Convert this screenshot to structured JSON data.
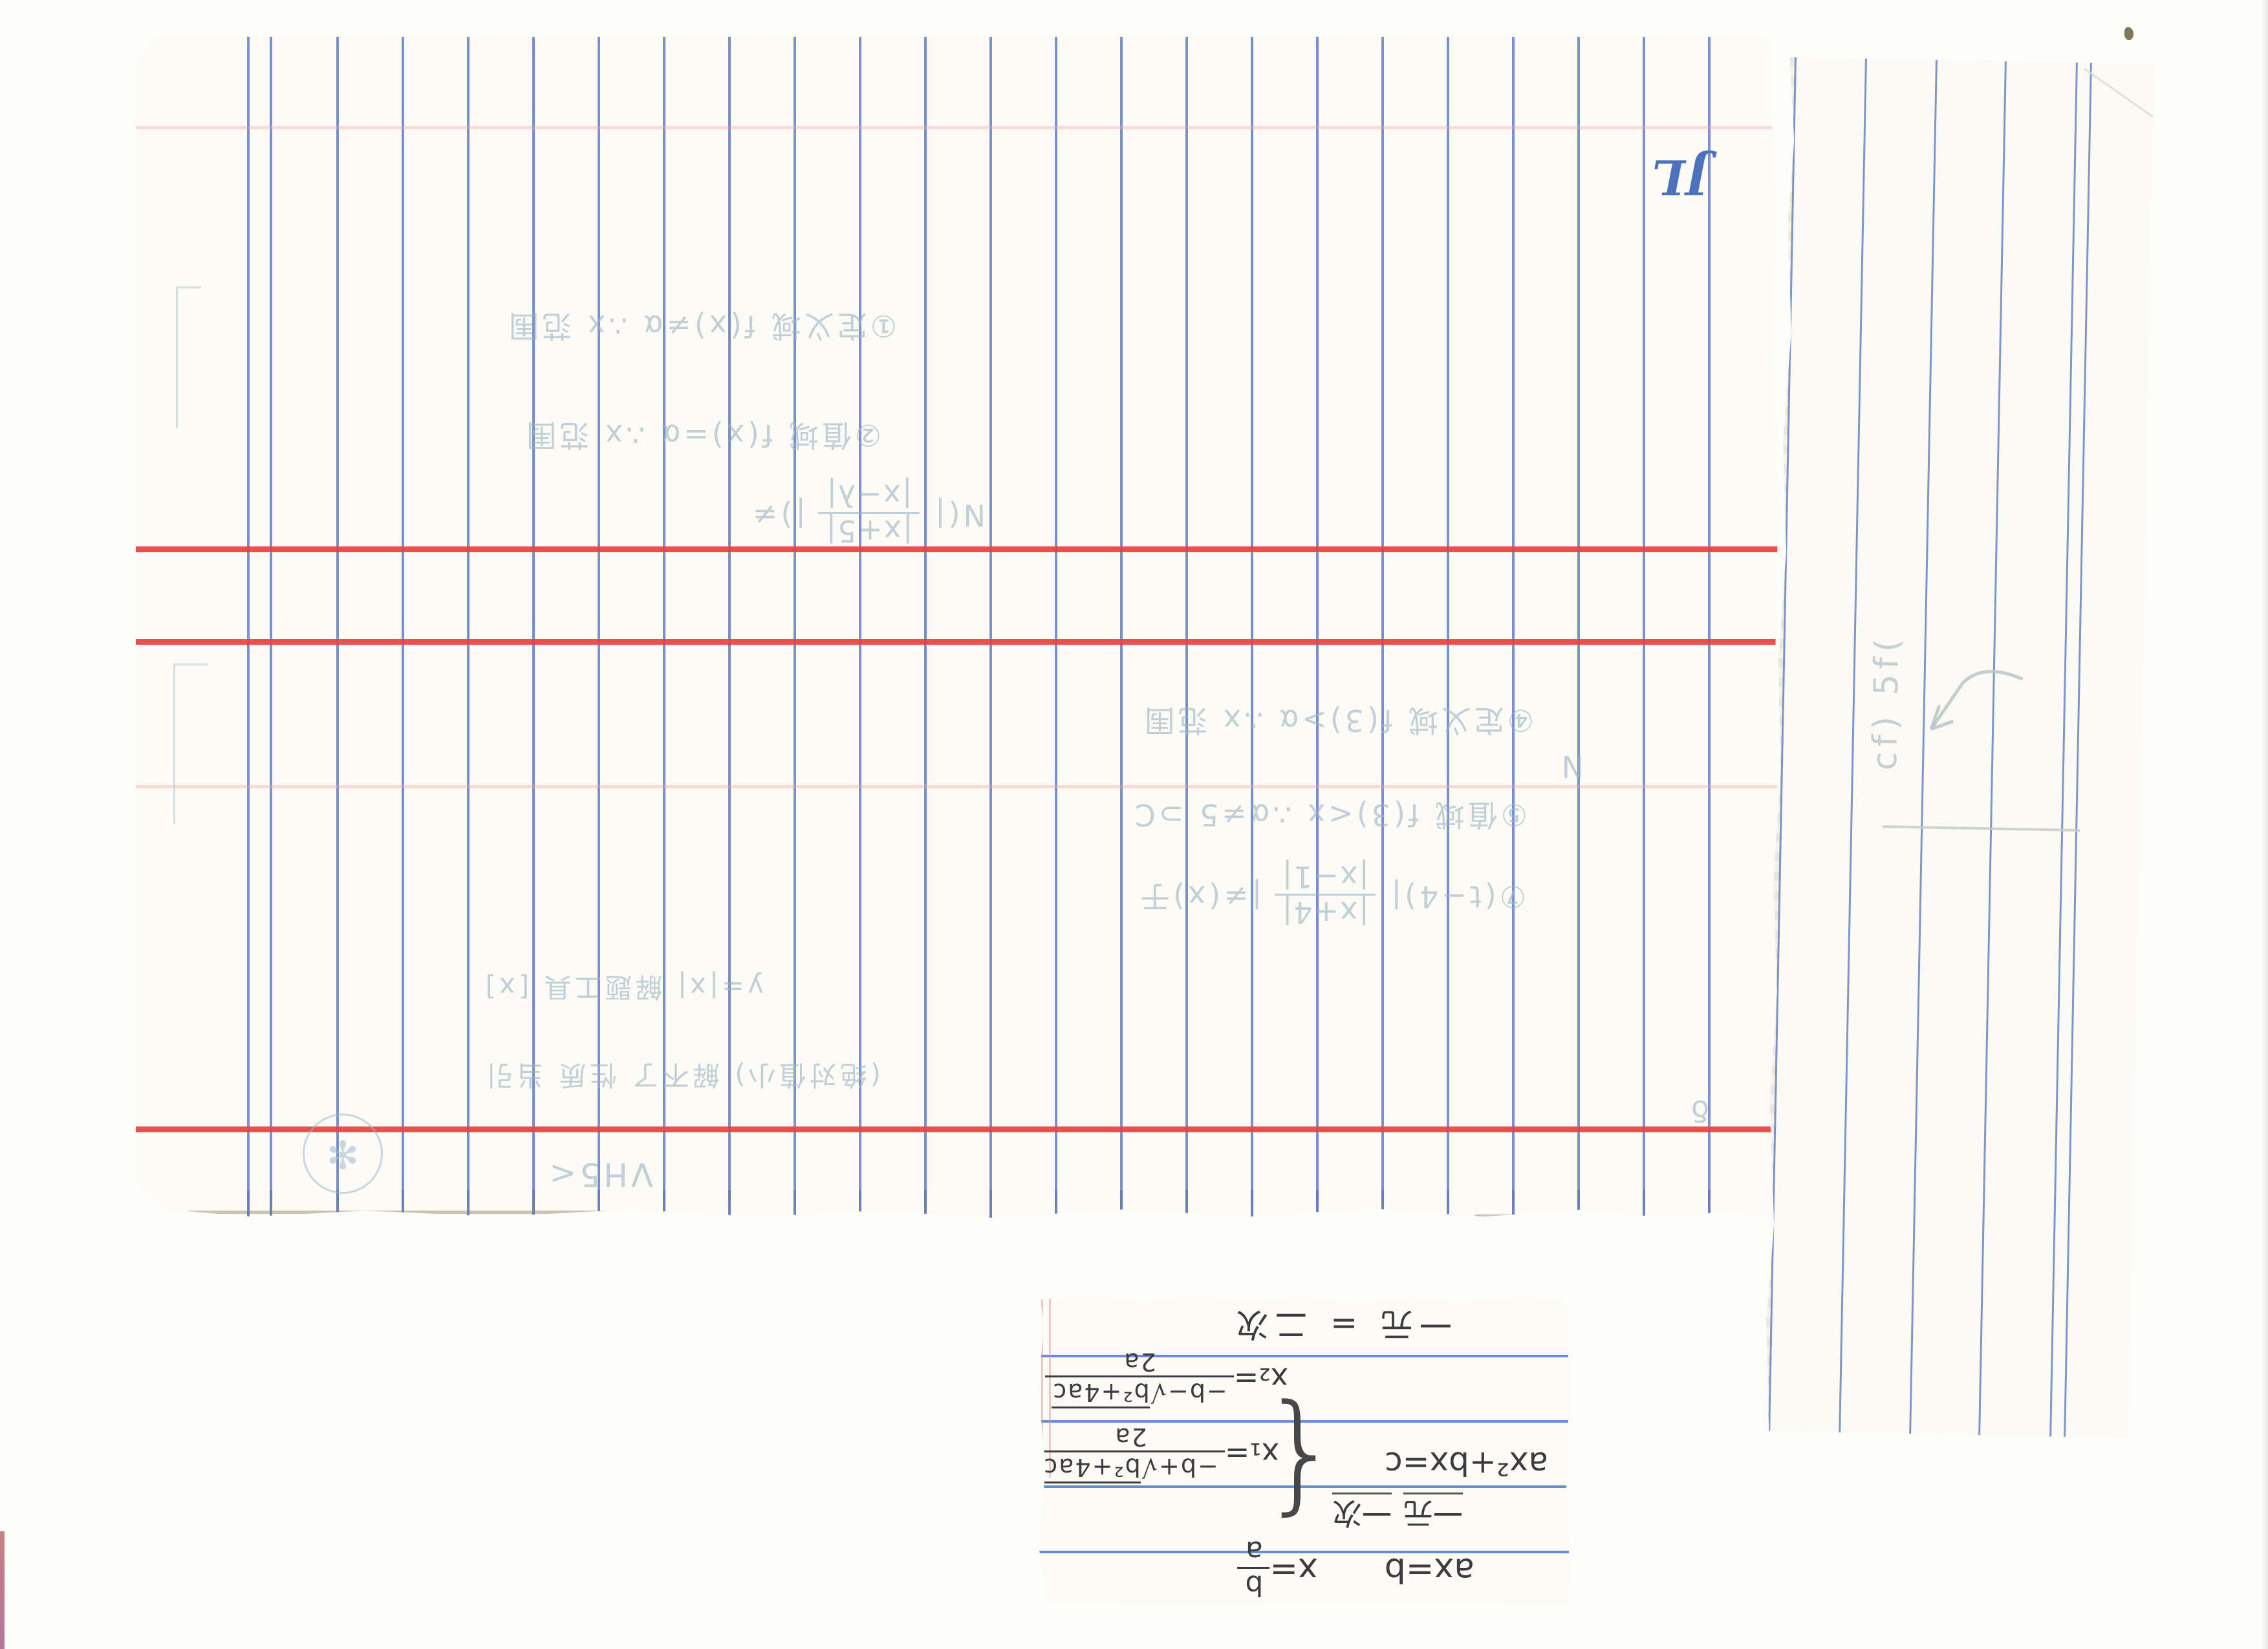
{
  "scene": {
    "description": "scan of ruled notebook pages with upside-down handwritten math notes"
  },
  "colors": {
    "scan_background": "#fdfdfb",
    "paper": "#fcfbf5",
    "ruled_blue": "#5c7cc5",
    "margin_red": "#e8413f",
    "faint_pink": "#eaaaa8",
    "pencil_faint": "#9db4c4",
    "pencil_dark": "#3c3c40",
    "logo_blue": "#4c71bd",
    "edge_red_sliver": "#c9666f"
  },
  "main_page": {
    "logo": "JL",
    "handwriting": {
      "top_line1": "①定义域 f(x)≠α ∴x 范围",
      "top_line2": "②值域 f(x)=α ∴x 范围",
      "expr1_prefix": "N(| ",
      "expr1_numerator": "|x+5|",
      "expr1_denominator": "|x−λ|",
      "expr1_suffix": " |)≠",
      "mid_line1": "④定义域 f(3)>α ∴x 范围",
      "mid_line2": "⑤值域 f(3)<x ∴α≠5 ⊃C",
      "expr2_prefix": "⑦(t−4)| ",
      "expr2_numerator": "|x+4|",
      "expr2_denominator": "|x−1|",
      "expr2_suffix": " |≠(x)于",
      "mid_line3": "y=|x| 解题工具 [x]",
      "mid_line4": "(绝对值小) 解不了 性质 当引",
      "bottom_scribble": "VH5<",
      "stray_mark1": "N",
      "stray_mark2": "δ",
      "circle_scribble": "✻"
    }
  },
  "side_strip": {
    "handwriting_marks": "cf) 5f("
  },
  "note_scrap": {
    "linear_eq": "ax=b",
    "linear_sol_prefix": "x=",
    "linear_sol_num": "b",
    "linear_sol_den": "a",
    "linear_label_1": "一元",
    "linear_label_2": "一次",
    "quad_eq": "ax²+bx=c",
    "brace": "{",
    "x1_prefix": "x₁=",
    "x1_num_pre": "−b+√",
    "x1_radicand": "b²+4ac",
    "x1_den": "2a",
    "x2_prefix": "x₂=",
    "x2_num_pre": "−b−√",
    "x2_radicand": "b²+4ac",
    "x2_den": "2a",
    "quad_label": "一元 = 二次"
  }
}
